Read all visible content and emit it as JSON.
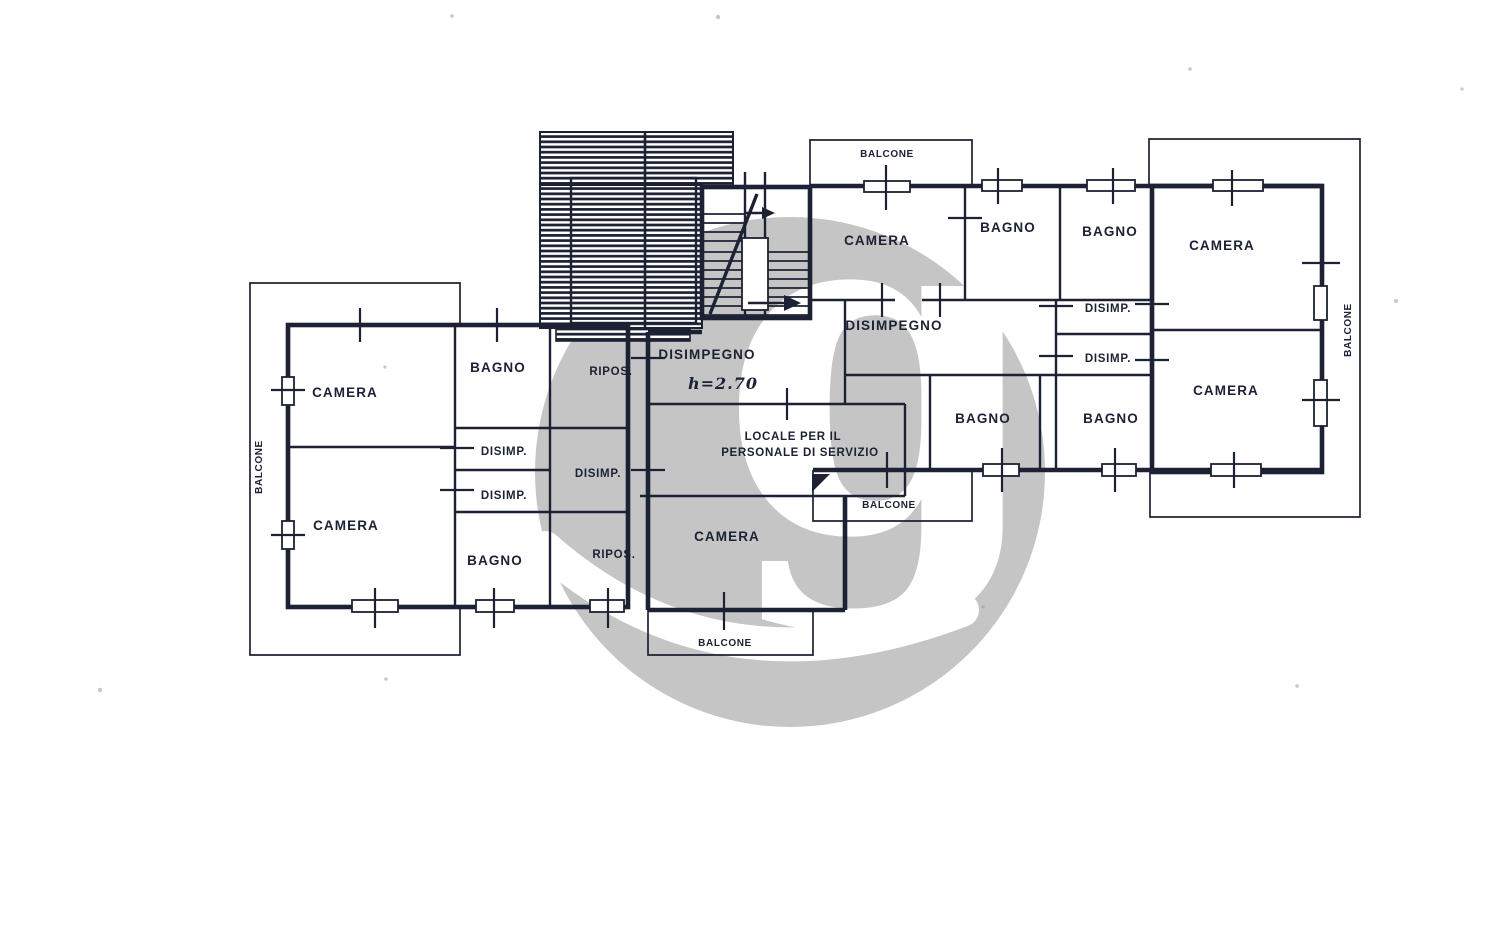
{
  "colors": {
    "ink": "#1c2133",
    "paper": "#ffffff"
  },
  "watermark": {
    "glyph": "g",
    "color": "#c5c5c5"
  },
  "plan": {
    "labels": {
      "camera_left_top": "CAMERA",
      "camera_left_bottom": "CAMERA",
      "bagno_left_top": "BAGNO",
      "disimp_left_upper": "DISIMP.",
      "disimp_left_lower": "DISIMP.",
      "bagno_left_bottom": "BAGNO",
      "ripos_top": "RIPOS.",
      "disimp_middle": "DISIMP.",
      "ripos_bottom": "RIPOS.",
      "disimpegno_center": "DISIMPEGNO",
      "ceiling_height": "h=2.70",
      "locale_line1": "LOCALE PER IL",
      "locale_line2": "PERSONALE DI SERVIZIO",
      "camera_center_bottom": "CAMERA",
      "camera_center_top": "CAMERA",
      "disimpegno_right": "DISIMPEGNO",
      "bagno_top_1": "BAGNO",
      "bagno_top_2": "BAGNO",
      "disimp_right_upper": "DISIMP.",
      "disimp_right_lower": "DISIMP.",
      "bagno_right_1": "BAGNO",
      "bagno_right_2": "BAGNO",
      "camera_right_top": "CAMERA",
      "camera_right_bottom": "CAMERA",
      "balcone_top": "BALCONE",
      "balcone_bottom": "BALCONE",
      "balcone_center": "BALCONE",
      "balcone_left": "BALCONE",
      "balcone_right": "BALCONE"
    }
  }
}
